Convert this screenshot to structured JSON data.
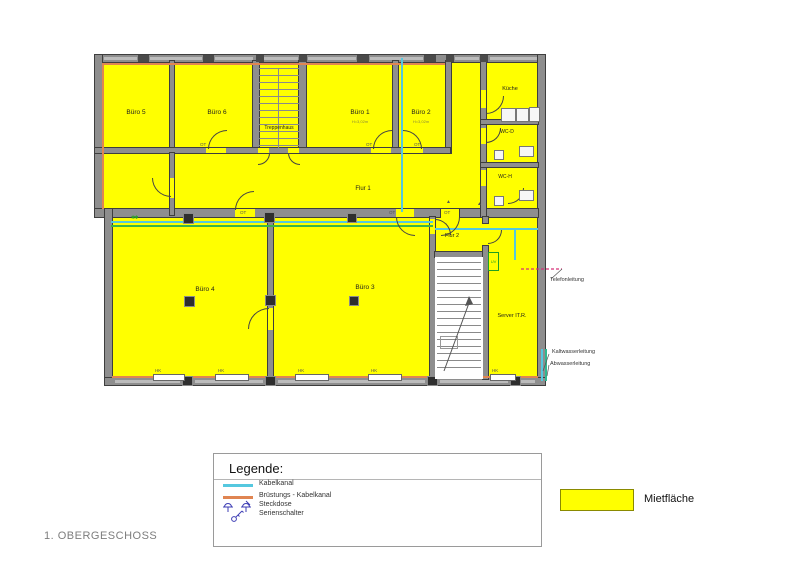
{
  "page": {
    "floor_label": "1. OBERGESCHOSS",
    "background": "#ffffff"
  },
  "plan": {
    "highlight_color": "#ffff00",
    "rooms": [
      {
        "id": "buero-5",
        "label": "Büro 5"
      },
      {
        "id": "buero-6",
        "label": "Büro 6"
      },
      {
        "id": "treppenhaus",
        "label": "Treppenhaus"
      },
      {
        "id": "buero-1",
        "label": "Büro 1",
        "note": "H=3,02m"
      },
      {
        "id": "buero-2",
        "label": "Büro 2",
        "note": "H=3,02m"
      },
      {
        "id": "kueche",
        "label": "Küche"
      },
      {
        "id": "wc-d",
        "label": "WC-D"
      },
      {
        "id": "wc-h",
        "label": "WC-H"
      },
      {
        "id": "flur-1",
        "label": "Flur 1"
      },
      {
        "id": "flur-2",
        "label": "Flur 2"
      },
      {
        "id": "buero-4",
        "label": "Büro 4"
      },
      {
        "id": "buero-3",
        "label": "Büro 3"
      },
      {
        "id": "server-it",
        "label": "Server IT.R."
      }
    ],
    "annotations": {
      "telefon": "Telefonleitung",
      "kaltwasser": "Kaltwasserleitung",
      "abwasser": "Abwasserleitung"
    },
    "uv_label": "UV",
    "door_label": "OT",
    "radiator_label": "HK",
    "socket_mark": "✱✱"
  },
  "legend": {
    "title": "Legende:",
    "items": [
      {
        "label": "Kabelkanal",
        "symbol": "cable-duct-line",
        "color": "#55c8df"
      },
      {
        "label": "Brüstungs - Kabelkanal",
        "symbol": "parapet-cable-duct-line",
        "color": "#e08552"
      },
      {
        "label": "Steckdose",
        "symbol": "socket-icon",
        "color": "#3c3cb4"
      },
      {
        "label": "Serienschalter",
        "symbol": "series-switch-icon",
        "color": "#3c3cb4"
      }
    ]
  },
  "mietflaeche": {
    "label": "Mietfläche",
    "color": "#ffff00"
  }
}
